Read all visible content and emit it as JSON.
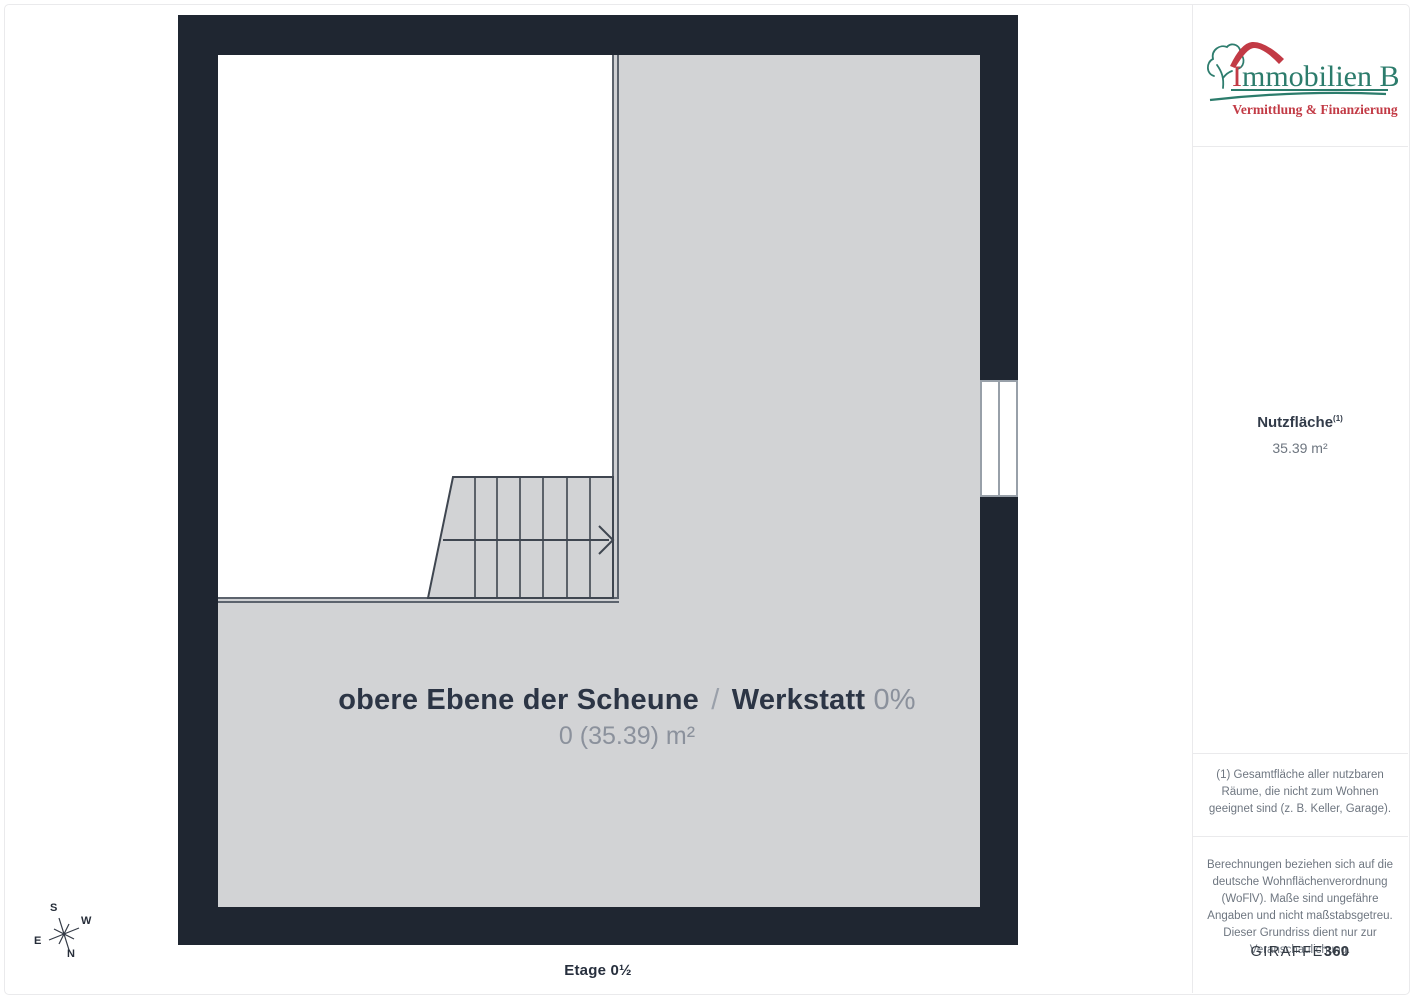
{
  "plan": {
    "title": {
      "part1": "obere Ebene der Scheune",
      "separator": "/",
      "part2": "Werkstatt",
      "percent": "0%"
    },
    "area_label": "0 (35.39) m²",
    "floor_label": "Etage 0½"
  },
  "compass": {
    "north": "N",
    "south": "S",
    "east": "E",
    "west": "W"
  },
  "sidebar": {
    "logo_title_initial": "I",
    "logo_title_rest": "mmobilien Bart",
    "logo_subtitle": "Vermittlung & Finanzierung",
    "metric_label": "Nutzfläche",
    "metric_footnote_ref": "(1)",
    "metric_value": "35.39 m²",
    "footnote": "(1) Gesamtfläche aller nutzbaren Räume, die nicht zum Wohnen geeignet sind (z. B. Keller, Garage).",
    "disclaimer": "Berechnungen beziehen sich auf die deutsche Wohnflächenverordnung (WoFlV). Maße sind ungefähre Angaben und nicht maßstabsgetreu. Dieser Grundriss dient nur zur Veranschaulichung.",
    "brand_name": "GIRAFFE",
    "brand_number": "360"
  },
  "colors": {
    "wall": "#1f2631",
    "floor": "#d2d3d5",
    "logo_green": "#2e7d6e",
    "logo_red": "#c23a45"
  }
}
